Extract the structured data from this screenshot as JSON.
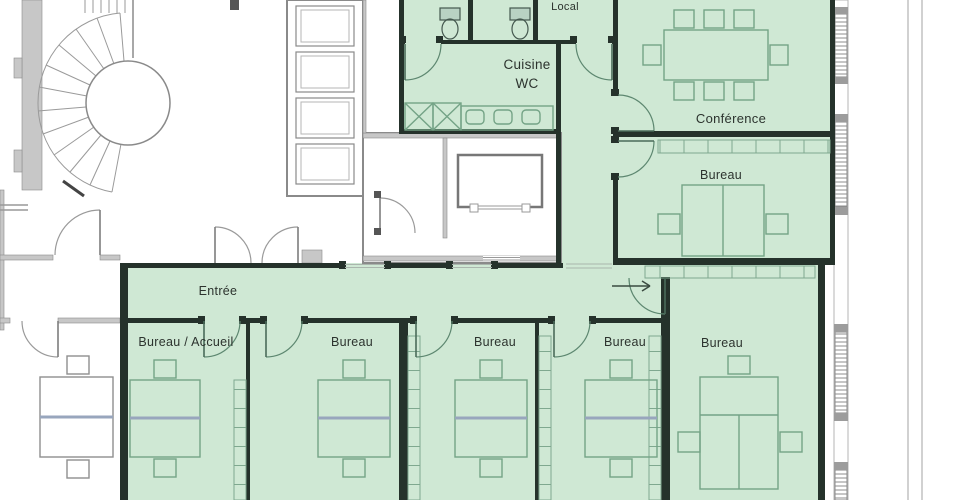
{
  "rooms": [
    {
      "name": "local",
      "label": "Local",
      "highlighted": true
    },
    {
      "name": "cuisine-wc",
      "line1": "Cuisine",
      "line2": "WC",
      "highlighted": true
    },
    {
      "name": "conference",
      "label": "Conférence",
      "highlighted": true
    },
    {
      "name": "bureau-mid-right",
      "label": "Bureau",
      "highlighted": true
    },
    {
      "name": "entree",
      "label": "Entrée",
      "highlighted": true
    },
    {
      "name": "bureau-accueil",
      "label": "Bureau / Accueil",
      "highlighted": true
    },
    {
      "name": "bureau-2",
      "label": "Bureau",
      "highlighted": true
    },
    {
      "name": "bureau-3",
      "label": "Bureau",
      "highlighted": true
    },
    {
      "name": "bureau-4",
      "label": "Bureau",
      "highlighted": true
    },
    {
      "name": "bureau-right",
      "label": "Bureau",
      "highlighted": true
    }
  ],
  "colors": {
    "highlight_green": "#cfe8d4",
    "wall_dark": "#25322b",
    "wall_gray": "#c7c7c7",
    "furniture_green": "#74a386",
    "text": "#2c332e"
  }
}
